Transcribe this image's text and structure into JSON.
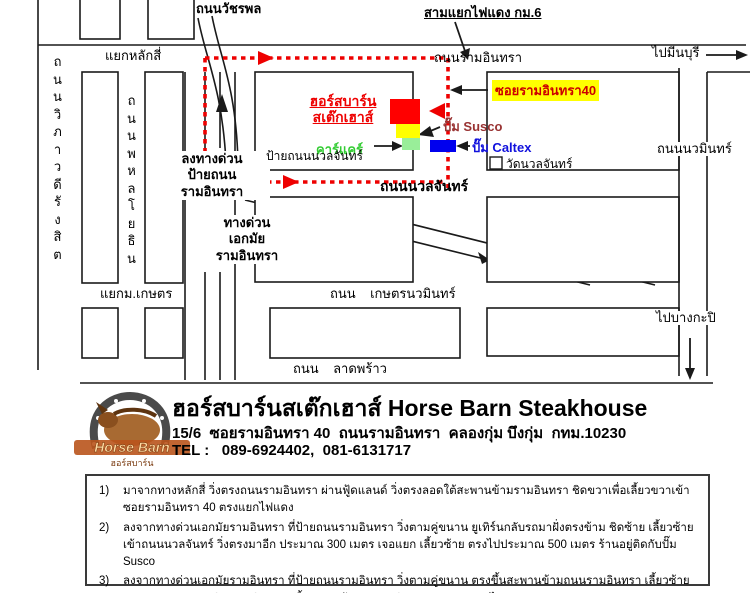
{
  "map": {
    "labels": {
      "watcharaphon": "ถนนวัชรพล",
      "sam_yaek": "สามแยกไฟแดง กม.6",
      "yaek_laksi": "แยกหลักสี่",
      "ram_inthra": "ถนนรามอินทรา",
      "pai_minburi": "ไปมีนบุรี",
      "vibhavadi": "ถ น น วิ ภ า ว ดี รั ง สิ ต",
      "phahonyothin": "ถ น น พ ห ล โ ย ธิ น",
      "exit_expressway": "ลงทางด่วน\nป้ายถนน\nรามอินทรา",
      "expressway": "ทางด่วน\nเอกมัย\nรามอินทรา",
      "restaurant": "ฮอร์สบาร์น\nสเต๊กเฮาส์",
      "soi40": "ซอยรามอินทรา40",
      "susco": "ปั๊ม Susco",
      "caltex": "ปั๊ม Caltex",
      "carcare": "คาร์แคร์",
      "nuanchan_sign": "ป้ายถนนนวลจันทร์",
      "nuanchan_road": "ถนนนวลจันทร์",
      "wat_nuanchan": "วัดนวลจันทร์",
      "nawamin": "ถนนนวมินทร์",
      "yaek_kaset": "แยกม.เกษตร",
      "kaset_nawamin": "ถนน    เกษตรนวมินทร์",
      "pai_bangkapi": "ไปบางกะปิ",
      "lat_phrao": "ถนน    ลาดพร้าว"
    },
    "colors": {
      "route": "#ee0000",
      "restaurant_marker": "#ff0000",
      "susco_marker": "#ffff00",
      "carcare_marker": "#99ee99",
      "caltex_marker": "#0000ee",
      "highlight": "#ffff00"
    }
  },
  "footer": {
    "logo": {
      "name_en": "Horse Barn",
      "name_th": "ฮอร์สบาร์น"
    },
    "title": "ฮอร์สบาร์นสเต๊กเฮาส์  Horse Barn Steakhouse",
    "address": "15/6  ซอยรามอินทรา 40  ถนนรามอินทรา  คลองกุ่ม บึงกุ่ม  กทม.10230",
    "tel": "TEL :   089-6924402,  081-6131717"
  },
  "directions": {
    "items": [
      {
        "num": "1)",
        "text": "มาจากทางหลักสี่  วิ่งตรงถนนรามอินทรา  ผ่านฟู้ดแลนด์ วิ่งตรงลอดใต้สะพานข้ามรามอินทรา  ชิดขวาเพื่อเลี้ยวขวาเข้าซอยรามอินทรา 40  ตรงแยกไฟแดง"
      },
      {
        "num": "2)",
        "text": "ลงจากทางด่วนเอกมัยรามอินทรา  ที่ป้ายถนนรามอินทรา  วิ่งตามคู่ขนาน ยูเทิร์นกลับรถมาฝั่งตรงข้าม ชิดซ้าย เลี้ยวซ้ายเข้าถนนนวลจันทร์ วิ่งตรงมาอีก ประมาณ 300 เมตร เจอแยก เลี้ยวซ้าย ตรงไปประมาณ 500 เมตร ร้านอยู่ติดกับปั๊ม Susco"
      },
      {
        "num": "3)",
        "text": "ลงจากทางด่วนเอกมัยรามอินทรา  ที่ป้ายถนนรามอินทรา  วิ่งตามคู่ขนาน  ตรงขึ้นสะพานข้ามถนนรามอินทรา เลี้ยวซ้ายวกกลับลงถนนรามอินทรา ชิดขวา เลี้ยวขวาเข้าซอยรามอินทรา 40 ตรงแยกไฟแดง"
      }
    ]
  }
}
